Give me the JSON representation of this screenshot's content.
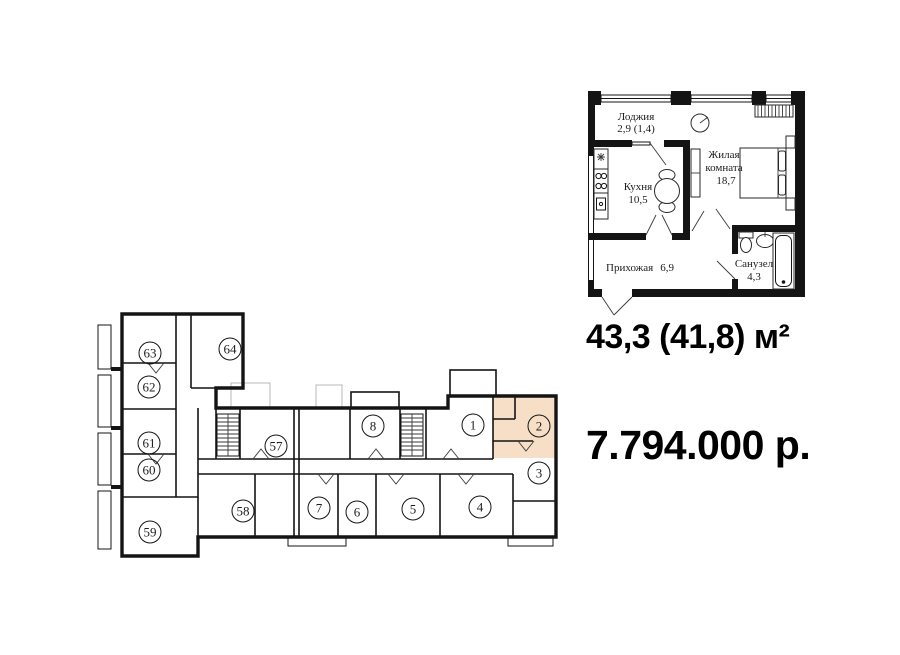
{
  "summary": {
    "area": "43,3 (41,8) м²",
    "price": "7.794.000 р."
  },
  "detail_plan": {
    "loggia_name": "Лоджия",
    "loggia_area": "2,9 (1,4)",
    "kitchen_name": "Кухня",
    "kitchen_area": "10,5",
    "living_name_line1": "Жилая",
    "living_name_line2": "комната",
    "living_area": "18,7",
    "hall_name": "Прихожая",
    "hall_area": "6,9",
    "bath_name": "Санузел",
    "bath_area": "4,3"
  },
  "building_plan": {
    "highlighted_apartment": "2",
    "highlight_color": "#f7dfc7",
    "apartments": {
      "n1": "1",
      "n2": "2",
      "n3": "3",
      "n4": "4",
      "n5": "5",
      "n6": "6",
      "n7": "7",
      "n8": "8",
      "n57": "57",
      "n58": "58",
      "n59": "59",
      "n60": "60",
      "n61": "61",
      "n62": "62",
      "n63": "63",
      "n64": "64"
    }
  }
}
